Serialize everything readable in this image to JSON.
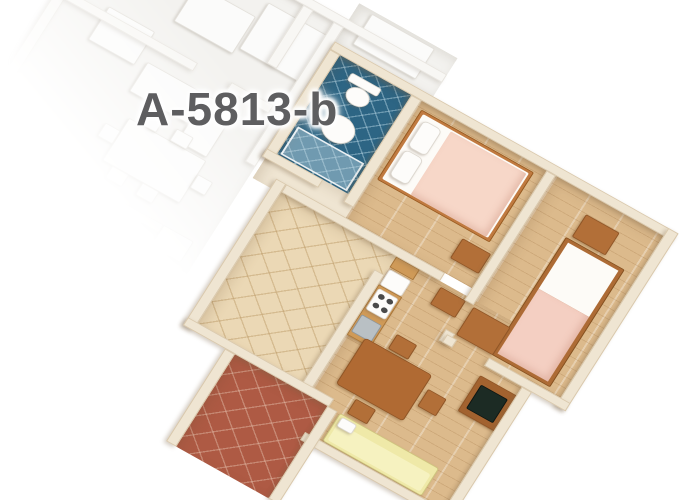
{
  "scene": {
    "type": "apartment-floorplan-3d-render",
    "background": "#ffffff"
  },
  "label": {
    "text": "A-5813-b",
    "color": "#5e5e60",
    "halo": "#ffffff"
  },
  "palette": {
    "wood_floor": "#dcba8c",
    "bath_tile": "#2d6584",
    "hall_tile": "#ebd8b5",
    "terrace_tile": "#ae5a44",
    "wall_cream": "#efe5d2",
    "wall_white": "#f8f7f4",
    "white_unit_floor": "#f3f2ef",
    "mattress_white": "#fdfbf7",
    "blanket_double": "#f7d7c8",
    "blanket_single": "#f4cfc2",
    "sofa_yellow": "#efe9a8",
    "sofa_cushion": "#f6f2c0",
    "furniture_wood": "#b26f38",
    "counter_wood": "#cf9a58",
    "tv_screen": "#1c2b24",
    "sink_metal": "#b9c0c4",
    "shower_glass": "#cfe3ea"
  },
  "units": {
    "highlighted": {
      "id": "A-5813-b",
      "rooms": [
        {
          "name": "bathroom",
          "floor": "blue-tile",
          "fixtures": [
            "toilet",
            "washbasin",
            "shower"
          ]
        },
        {
          "name": "hallway",
          "floor": "beige-tile"
        },
        {
          "name": "kitchen",
          "fixtures": [
            "counter",
            "stove",
            "sink",
            "washing-machine",
            "upper-cabinet"
          ]
        },
        {
          "name": "living-dining-room",
          "floor": "wood",
          "furniture": [
            "dining-table",
            "chair",
            "chair",
            "chair",
            "tv-cabinet",
            "tv",
            "sofa-daybed",
            "stool"
          ]
        },
        {
          "name": "bedroom-1",
          "floor": "wood",
          "furniture": [
            "double-bed",
            "nightstand"
          ]
        },
        {
          "name": "bedroom-2",
          "floor": "wood",
          "furniture": [
            "single-bed",
            "nightstand",
            "dresser"
          ]
        },
        {
          "name": "terrace",
          "floor": "terracotta-tile"
        }
      ]
    },
    "adjacent": {
      "style": "white-faded",
      "rooms": [
        "bedrooms",
        "dining-area",
        "kitchen",
        "sitting-area"
      ],
      "furniture": [
        "bed",
        "bed",
        "bed",
        "wardrobe",
        "dining-table",
        "chairs",
        "kitchen-counter",
        "couch",
        "side-table"
      ]
    }
  }
}
